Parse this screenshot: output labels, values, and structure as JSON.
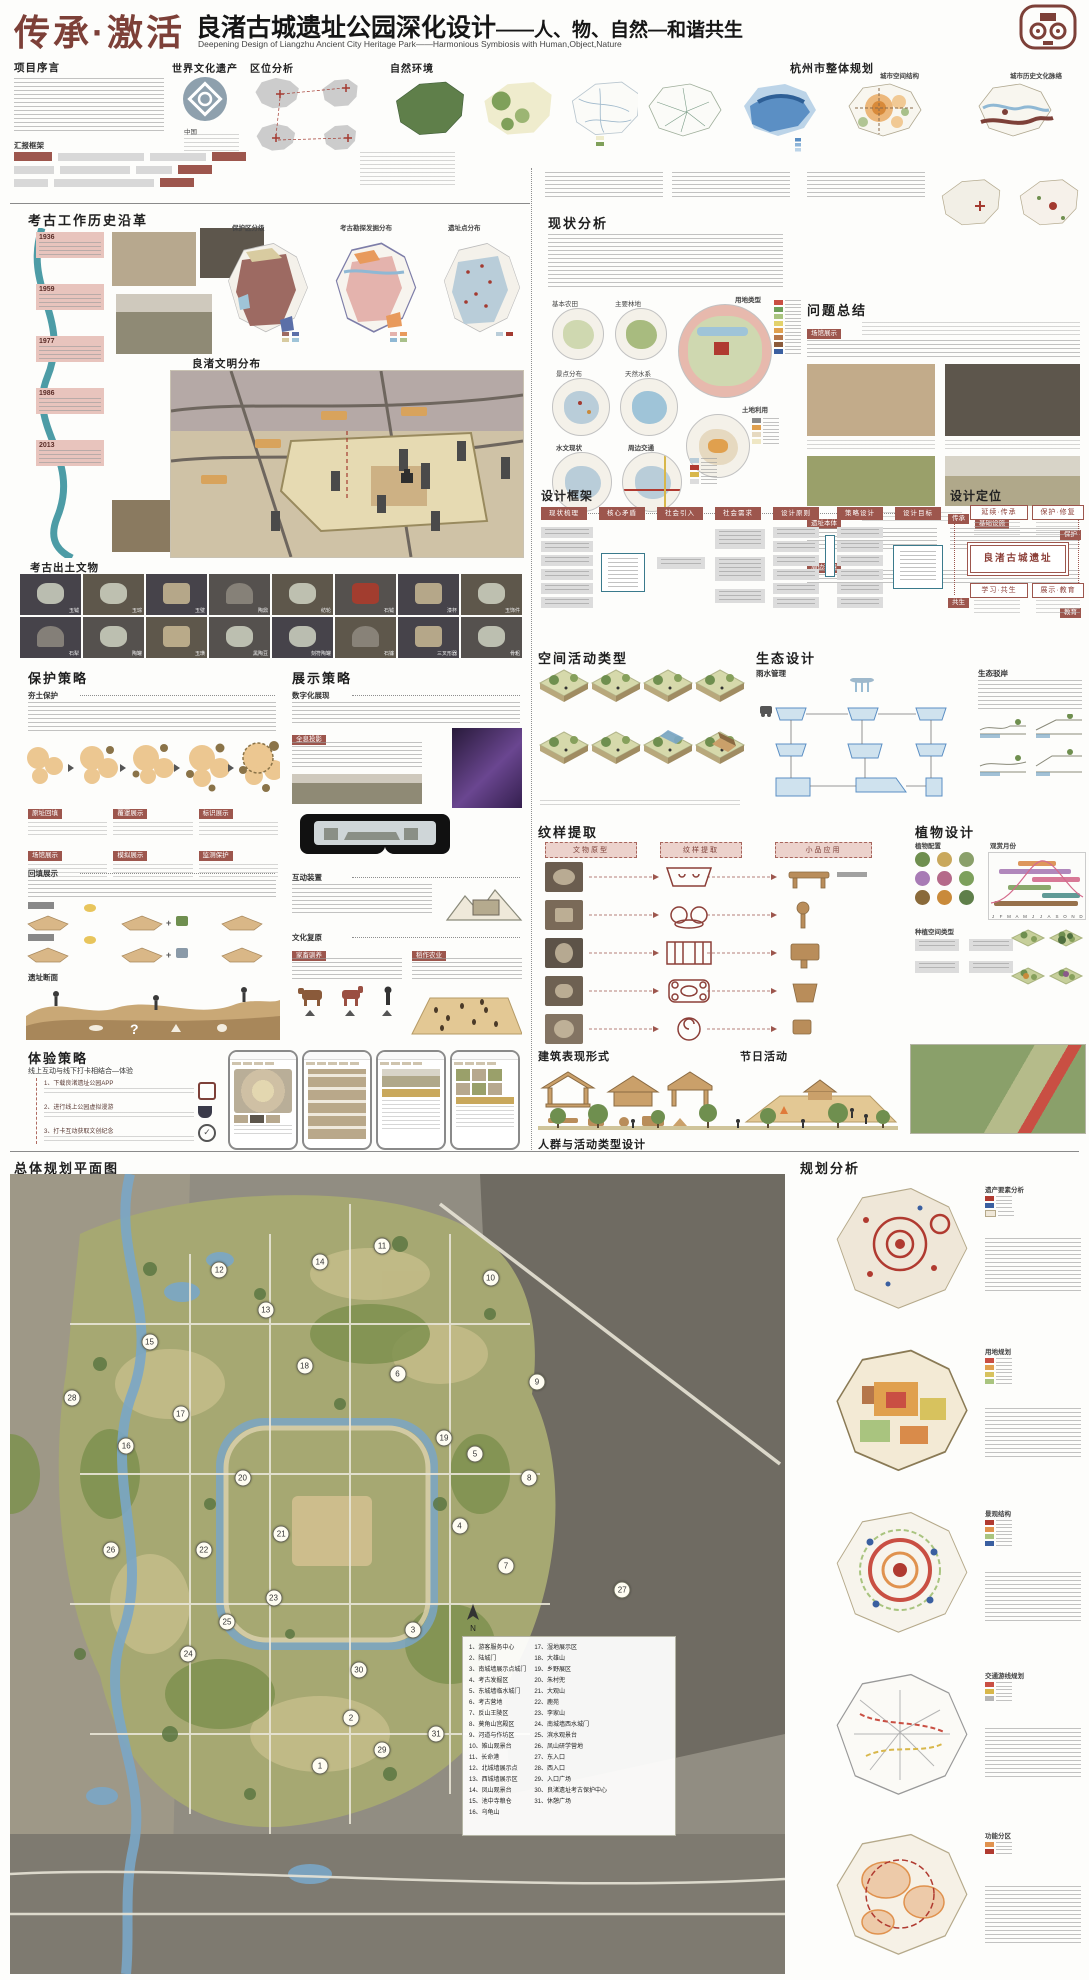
{
  "header": {
    "title_red": "传承·激活",
    "title_main": "良渚古城遗址公园深化设计",
    "title_suffix": "——人、物、自然—和谐共生",
    "subtitle_en": "Deepening Design of Liangzhu Ancient City Heritage Park——Harmonious Symbiosis with Human,Object,Nature"
  },
  "top": {
    "preface_title": "项目序言",
    "report_framework": "汇报框架",
    "heritage_title": "世界文化遗产",
    "heritage_country": "中国",
    "location_title": "区位分析",
    "nature_title": "自然环境",
    "hangzhou_title": "杭州市整体规划",
    "hz_sub1": "城市空间结构",
    "hz_sub2": "城市历史文化脉络"
  },
  "archaeo": {
    "history_title": "考古工作历史沿革",
    "timeline": [
      {
        "year": "1936"
      },
      {
        "year": "1959"
      },
      {
        "year": "1977"
      },
      {
        "year": "1986"
      },
      {
        "year": "2013"
      }
    ],
    "map1_label": "保护区分级",
    "map2_label": "考古勘探发掘分布",
    "map3_label": "遗址点分布",
    "civilization_title": "良渚文明分布",
    "artifacts_title": "考古出土文物",
    "artifacts": [
      "玉钺",
      "玉琮",
      "玉璧",
      "陶鼎",
      "纺轮",
      "石钺",
      "漆杯",
      "玉饰件",
      "石犁",
      "陶罐",
      "玉璜",
      "黑陶豆",
      "刻符陶罐",
      "石镰",
      "三叉形器",
      "骨耜"
    ]
  },
  "status": {
    "title": "现状分析",
    "c_farm": "基本农田",
    "c_forest": "主要林地",
    "c_landuse": "用地类型",
    "c_spots": "景点分布",
    "c_water": "天然水系",
    "c_soil": "土地利用",
    "c_hydro": "水文现状",
    "c_traffic": "周边交通"
  },
  "problems": {
    "title": "问题总结",
    "chips": [
      "场馆展示",
      "遗址本体",
      "基础设施",
      "周边环境"
    ]
  },
  "framework": {
    "title": "设计框架",
    "steps": [
      "现状梳理",
      "核心矛盾",
      "社会引入",
      "社会需求",
      "设计原则",
      "策略设计",
      "设计目标"
    ]
  },
  "positioning": {
    "title": "设计定位",
    "center": "良渚古城遗址",
    "corners": [
      "延续·传承",
      "保护·修复",
      "学习·共生",
      "展示·教育"
    ],
    "sides": [
      "传承",
      "保护",
      "共生",
      "教育"
    ]
  },
  "protection": {
    "title": "保护策略",
    "sub1": "夯土保护",
    "sub2": "回填展示",
    "sub3": "遗址断面",
    "labels": [
      "原址回填",
      "覆罩展示",
      "标识展示",
      "场馆展示",
      "模拟展示",
      "监测保护"
    ]
  },
  "exhibition": {
    "title": "展示策略",
    "sub_digital": "数字化展现",
    "chip_holo": "全息投影",
    "sub_interact": "互动装置",
    "sub_culture": "文化复原",
    "chip_animal": "家畜驯养",
    "chip_rice": "稻作农业"
  },
  "experience": {
    "title": "体验策略",
    "subtitle": "线上互动与线下打卡相结合—体验",
    "items": [
      "1、下载良渚遗址公园APP",
      "2、进行线上公园虚拟漫游",
      "3、打卡互动获取文创纪念"
    ]
  },
  "spatial": {
    "title": "空间活动类型"
  },
  "eco": {
    "title": "生态设计",
    "sub1": "雨水管理",
    "sub2": "生态驳岸"
  },
  "pattern": {
    "title": "纹样提取",
    "headers": [
      "文物原型",
      "纹样提取",
      "小品应用"
    ]
  },
  "plants": {
    "title": "植物设计",
    "sub1": "植物配置",
    "sub2": "观赏月份",
    "sub3": "种植空间类型",
    "months": [
      "J",
      "F",
      "M",
      "A",
      "M",
      "J",
      "J",
      "A",
      "S",
      "O",
      "N",
      "D"
    ]
  },
  "arch": {
    "title": "建筑表现形式"
  },
  "festival": {
    "title": "节日活动"
  },
  "crowd": {
    "title": "人群与活动类型设计"
  },
  "masterplan": {
    "title": "总体规划平面图",
    "north": "N",
    "legend_col1": [
      "1、游客服务中心",
      "2、陆城门",
      "3、南城墙展示点城门",
      "4、考古发掘区",
      "5、东城墙临水城门",
      "6、考古营地",
      "7、反山王陵区",
      "8、莫角山宫殿区",
      "9、河道与作坊区",
      "10、雉山观景台",
      "11、长命港",
      "12、北城墙展示点",
      "13、西城墙展示区",
      "14、凤山观景台",
      "15、池中寺粮仓",
      "16、乌龟山"
    ],
    "legend_col2": [
      "17、湿地展示区",
      "18、大雄山",
      "19、乡野展区",
      "20、朱村兜",
      "21、大观山",
      "22、鹿苑",
      "23、李家山",
      "24、南城墙西水城门",
      "25、滨水观景台",
      "26、凤山研学营地",
      "27、东入口",
      "28、西入口",
      "29、入口广场",
      "30、良渚遗址考古保护中心",
      "31、休憩广场"
    ],
    "markers": [
      {
        "n": 1,
        "x": 40,
        "y": 74
      },
      {
        "n": 2,
        "x": 44,
        "y": 68
      },
      {
        "n": 3,
        "x": 52,
        "y": 57
      },
      {
        "n": 4,
        "x": 58,
        "y": 44
      },
      {
        "n": 5,
        "x": 60,
        "y": 35
      },
      {
        "n": 6,
        "x": 50,
        "y": 25
      },
      {
        "n": 7,
        "x": 64,
        "y": 49
      },
      {
        "n": 8,
        "x": 67,
        "y": 38
      },
      {
        "n": 9,
        "x": 68,
        "y": 26
      },
      {
        "n": 10,
        "x": 62,
        "y": 13
      },
      {
        "n": 11,
        "x": 48,
        "y": 9
      },
      {
        "n": 12,
        "x": 27,
        "y": 12
      },
      {
        "n": 13,
        "x": 33,
        "y": 17
      },
      {
        "n": 14,
        "x": 40,
        "y": 11
      },
      {
        "n": 15,
        "x": 18,
        "y": 21
      },
      {
        "n": 16,
        "x": 15,
        "y": 34
      },
      {
        "n": 17,
        "x": 22,
        "y": 30
      },
      {
        "n": 18,
        "x": 38,
        "y": 24
      },
      {
        "n": 19,
        "x": 56,
        "y": 33
      },
      {
        "n": 20,
        "x": 30,
        "y": 38
      },
      {
        "n": 21,
        "x": 35,
        "y": 45
      },
      {
        "n": 22,
        "x": 25,
        "y": 47
      },
      {
        "n": 23,
        "x": 34,
        "y": 53
      },
      {
        "n": 24,
        "x": 23,
        "y": 60
      },
      {
        "n": 25,
        "x": 28,
        "y": 56
      },
      {
        "n": 26,
        "x": 13,
        "y": 47
      },
      {
        "n": 27,
        "x": 79,
        "y": 52
      },
      {
        "n": 28,
        "x": 8,
        "y": 28
      },
      {
        "n": 29,
        "x": 48,
        "y": 72
      },
      {
        "n": 30,
        "x": 45,
        "y": 62
      },
      {
        "n": 31,
        "x": 55,
        "y": 70
      }
    ]
  },
  "analysis": {
    "title": "规划分析",
    "maps": [
      {
        "label": "遗产要素分析"
      },
      {
        "label": "用地规划"
      },
      {
        "label": "景观结构"
      },
      {
        "label": "交通游线规划"
      },
      {
        "label": "功能分区"
      }
    ]
  }
}
